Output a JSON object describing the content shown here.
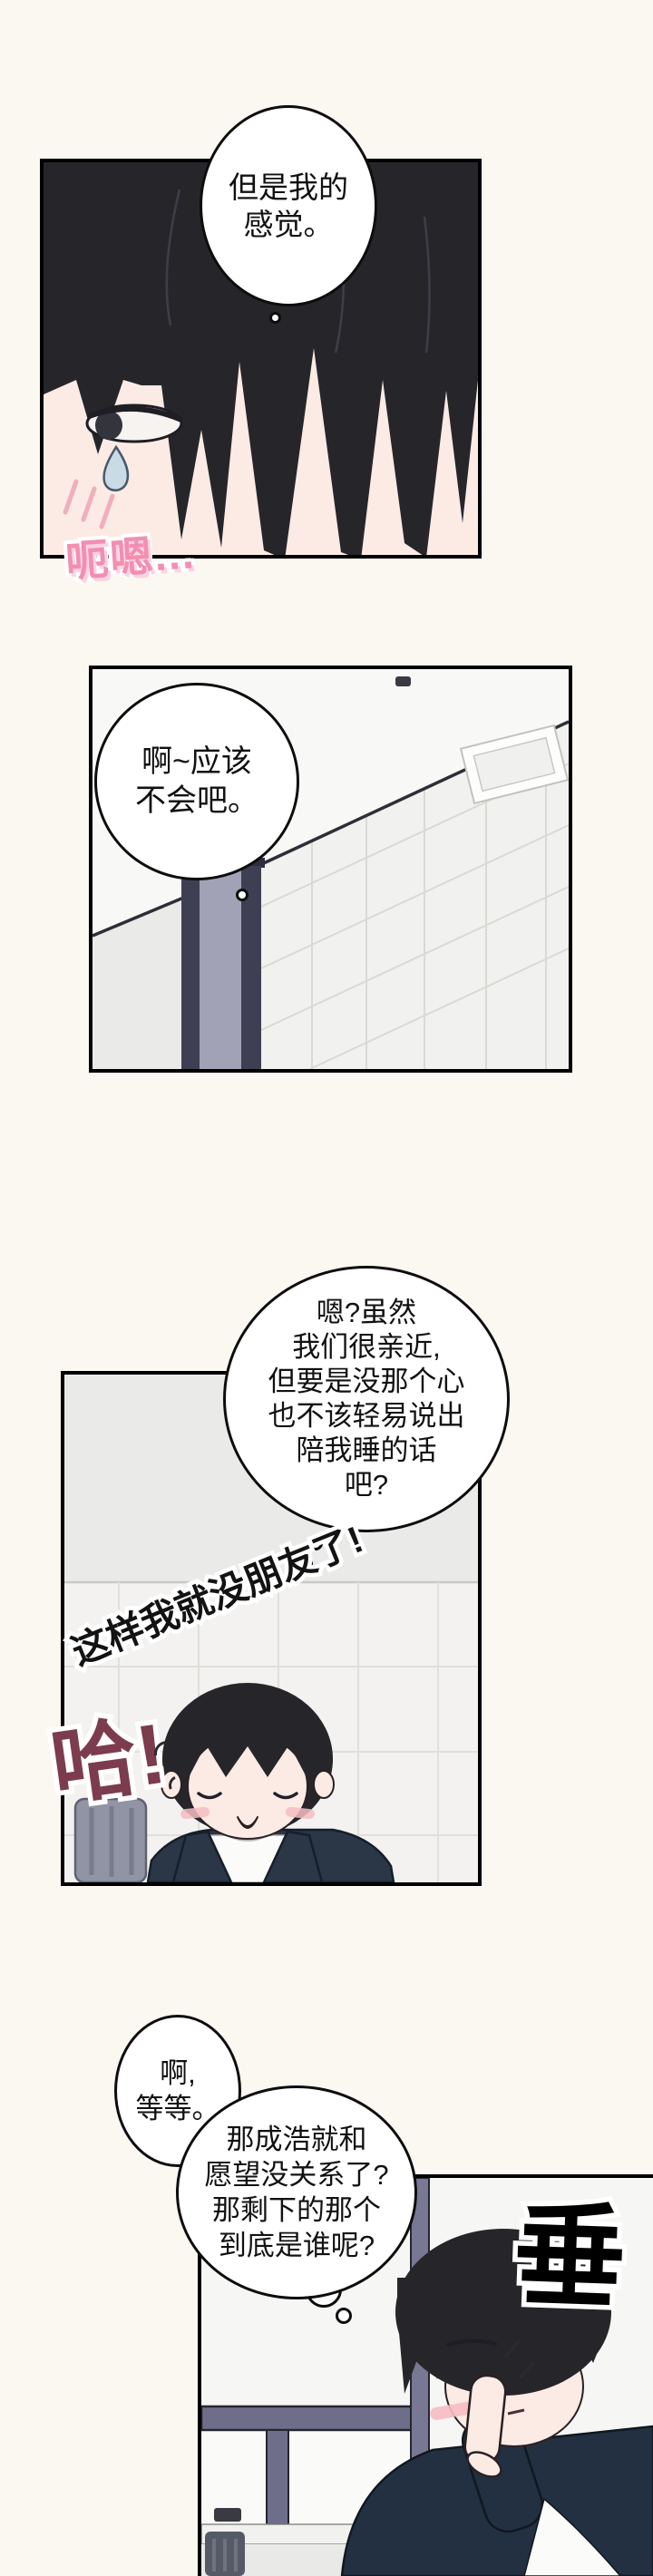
{
  "colors": {
    "page_bg": "#FBF7F1",
    "panel_border": "#000000",
    "hair": "#26262A",
    "skin": "#FCEBE5",
    "blush": "#F6BDC2",
    "jacket": "#223042",
    "jacket_light": "#2B3647",
    "shirt": "#FBFBF9",
    "wall_light": "#F3F2F0",
    "wall_dark": "#EAEAE8",
    "frame_purple": "#6E6E8A",
    "pink_sfx": "#F28FB1",
    "maroon_sfx": "#7C3C4E",
    "sweat": "#C9DCE6"
  },
  "bubbles": {
    "b1": {
      "type": "speech",
      "lines": [
        "但是我的",
        "感觉。"
      ]
    },
    "b2": {
      "type": "speech",
      "lines": [
        "啊~应该",
        "不会吧。"
      ]
    },
    "b3": {
      "type": "thought",
      "lines": [
        "嗯?虽然",
        "我们很亲近,",
        "但要是没那个心",
        "也不该轻易说出",
        "陪我睡的话",
        "吧?"
      ]
    },
    "b4": {
      "type": "speech",
      "lines": [
        "啊,",
        "等等。"
      ]
    },
    "b5": {
      "type": "thought",
      "lines": [
        "那成浩就和",
        "愿望没关系了?",
        "那剩下的那个",
        "到底是谁呢?"
      ]
    }
  },
  "sfx": {
    "murmur": "呃嗯...",
    "no_friends": "这样我就没朋友了!",
    "ha": "哈!",
    "big_char": "垂"
  }
}
